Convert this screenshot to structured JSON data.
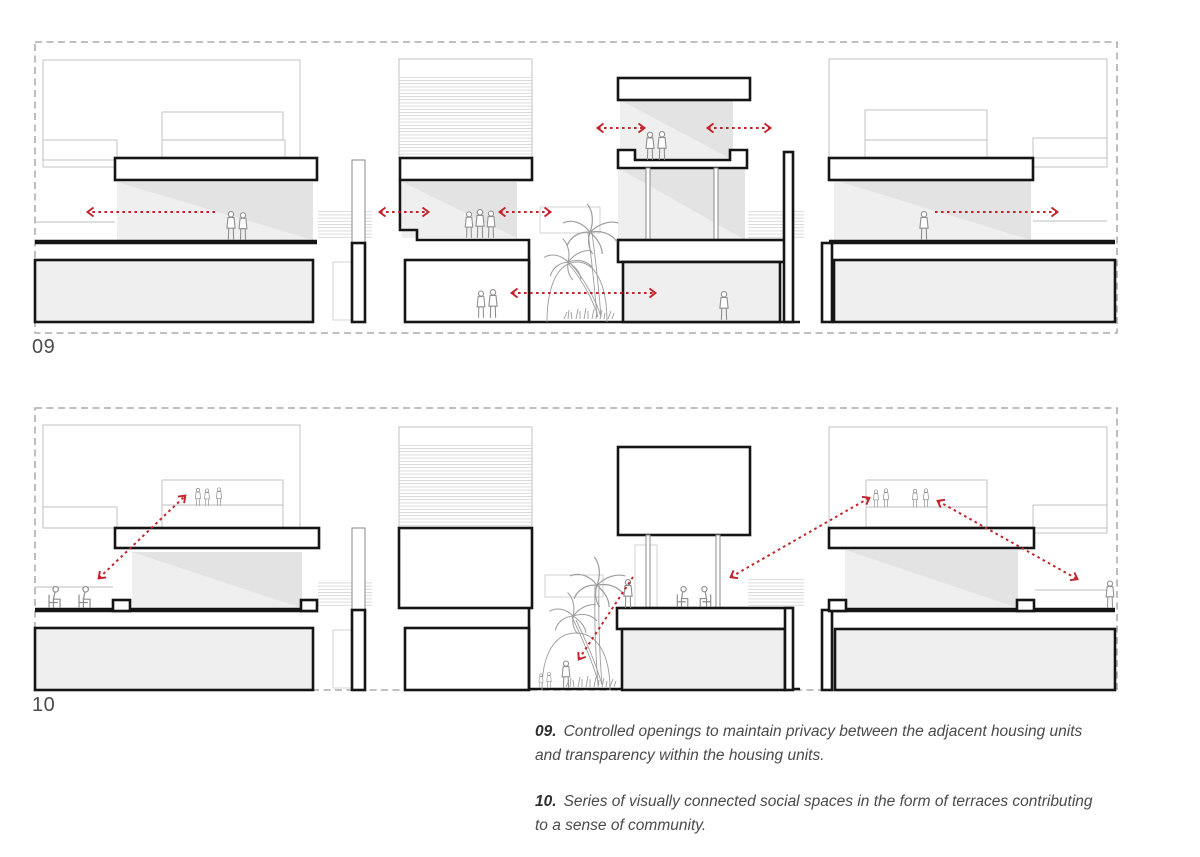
{
  "document": {
    "type": "architecture-concept-diagram-sheet",
    "background": "#ffffff"
  },
  "figures": [
    {
      "id": "fig-09",
      "label": "09",
      "caption_number": "09.",
      "caption_text": "Controlled openings to maintain privacy between the adjacent housing units\nand transparency within the housing units.",
      "drawing_subject": "section through housing units with horizontal sight-line arrows"
    },
    {
      "id": "fig-10",
      "label": "10",
      "caption_number": "10.",
      "caption_text": "Series of visually connected social spaces in the form of terraces contributing\nto a sense of community.",
      "drawing_subject": "section through housing units with diagonal sight-line arrows between terraces"
    }
  ],
  "colors": {
    "arrow_red": "#c42329",
    "section_black": "#151515",
    "light_line": "#bdbdbd",
    "room_fill": "#efefef",
    "room_shade": "#e3e3e3",
    "border_dash": "#9b9b9b",
    "text_muted": "#4a4a4a",
    "label_text": "#4c4c4c"
  }
}
